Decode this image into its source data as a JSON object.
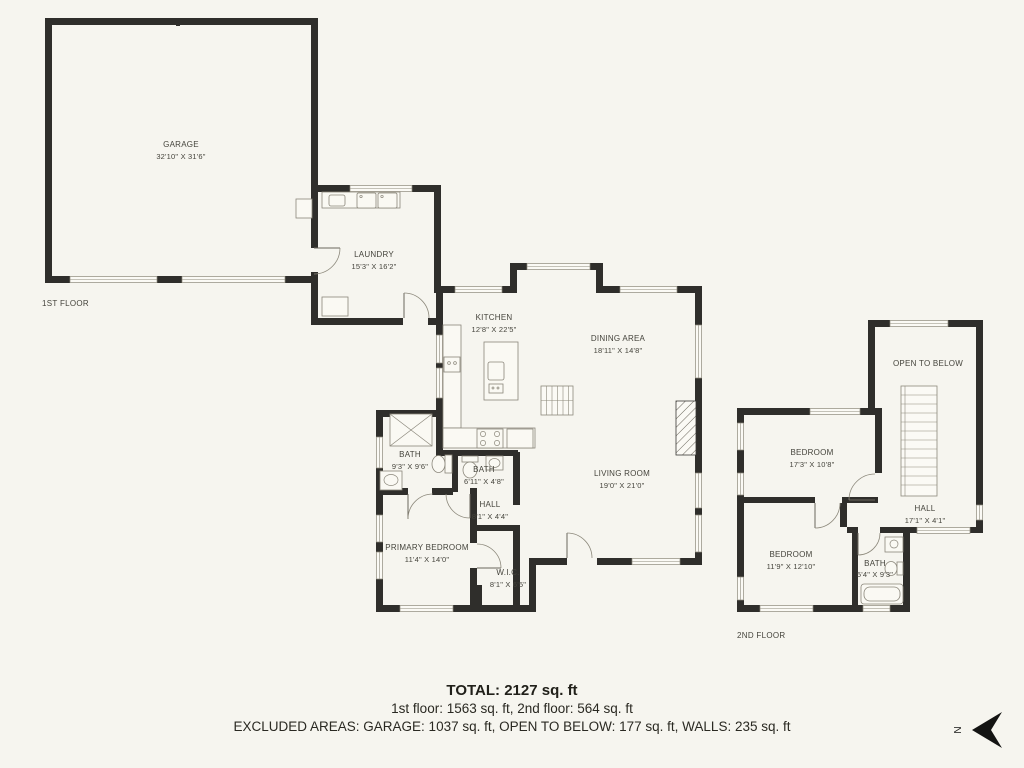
{
  "floor_tags": {
    "first": "1ST FLOOR",
    "second": "2ND FLOOR"
  },
  "rooms": {
    "garage": {
      "name": "GARAGE",
      "dims": "32'10\" X 31'6\""
    },
    "laundry": {
      "name": "LAUNDRY",
      "dims": "15'3\" X 16'2\""
    },
    "kitchen": {
      "name": "KITCHEN",
      "dims": "12'8\" X 22'5\""
    },
    "dining": {
      "name": "DINING AREA",
      "dims": "18'11\" X 14'8\""
    },
    "living": {
      "name": "LIVING ROOM",
      "dims": "19'0\" X 21'0\""
    },
    "bath1": {
      "name": "BATH",
      "dims": "9'3\" X 9'6\""
    },
    "bath2": {
      "name": "BATH",
      "dims": "6'11\" X 4'8\""
    },
    "hall1": {
      "name": "HALL",
      "dims": "8'1\" X 4'4\""
    },
    "primary_bedroom": {
      "name": "PRIMARY BEDROOM",
      "dims": "11'4\" X 14'0\""
    },
    "wic": {
      "name": "W.I.C.",
      "dims": "8'1\" X 6'5\""
    },
    "open_to_below": {
      "name": "OPEN TO BELOW",
      "dims": ""
    },
    "bedroom2": {
      "name": "BEDROOM",
      "dims": "17'3\" X 10'8\""
    },
    "hall2": {
      "name": "HALL",
      "dims": "17'1\" X 4'1\""
    },
    "bedroom3": {
      "name": "BEDROOM",
      "dims": "11'9\" X 12'10\""
    },
    "bath3": {
      "name": "BATH",
      "dims": "5'4\" X 9'3\""
    }
  },
  "summary": {
    "total": "TOTAL: 2127 sq. ft",
    "floors": "1st floor: 1563 sq. ft, 2nd floor: 564 sq. ft",
    "excluded": "EXCLUDED AREAS: GARAGE: 1037 sq. ft, OPEN TO BELOW: 177 sq. ft, WALLS: 235 sq. ft"
  },
  "compass": {
    "letter": "N"
  },
  "colors": {
    "background": "#f6f5ef",
    "wall": "#2f2e2b",
    "fixture_line": "#8a867a",
    "label_text": "#45443c",
    "summary_text": "#21201a"
  }
}
